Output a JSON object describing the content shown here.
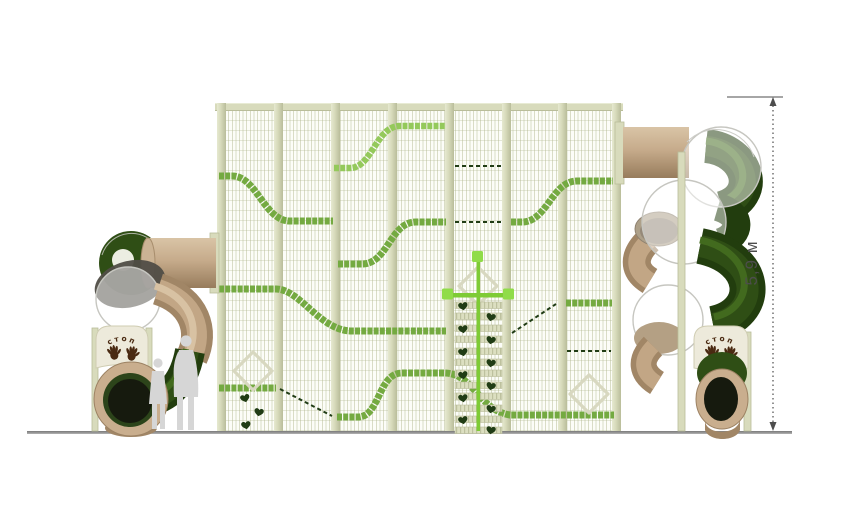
{
  "scene": {
    "type": "playground-equipment-elevation-render",
    "dimension_label": "5,9 м",
    "stop_sign_left": "стоп",
    "stop_sign_right": "стоп"
  },
  "structure": {
    "wall_panels": 7,
    "wall_posts": 8,
    "ladder_rungs": 12,
    "paw_marks": 15,
    "diamond_frames": 3,
    "slides": 2,
    "scale_figures": 2
  },
  "palette": {
    "frame-cream": "#d8dbbc",
    "frame-edge": "#b9bd9a",
    "band-green": "#74aa41",
    "band-green-light": "#94c95b",
    "accent-green": "#7ecb35",
    "accent-green-bright": "#90dc49",
    "rope-green": "#203c15",
    "slide-green": "#2f4e15",
    "slide-green-dark": "#223d0e",
    "slide-green-hl": "#426a1e",
    "slide-tan": "#c2a685",
    "slide-tan-light": "#d8c2a3",
    "slide-tan-dark": "#a18666",
    "dome-stroke": "#c6c6c0",
    "sign-cream": "#edeadb",
    "sign-brown": "#4a2a12",
    "silhouette": "#d6d6d6",
    "ground": "#949494",
    "dim-gray": "#4d4d4d",
    "diamond": "#d8d8c0"
  }
}
